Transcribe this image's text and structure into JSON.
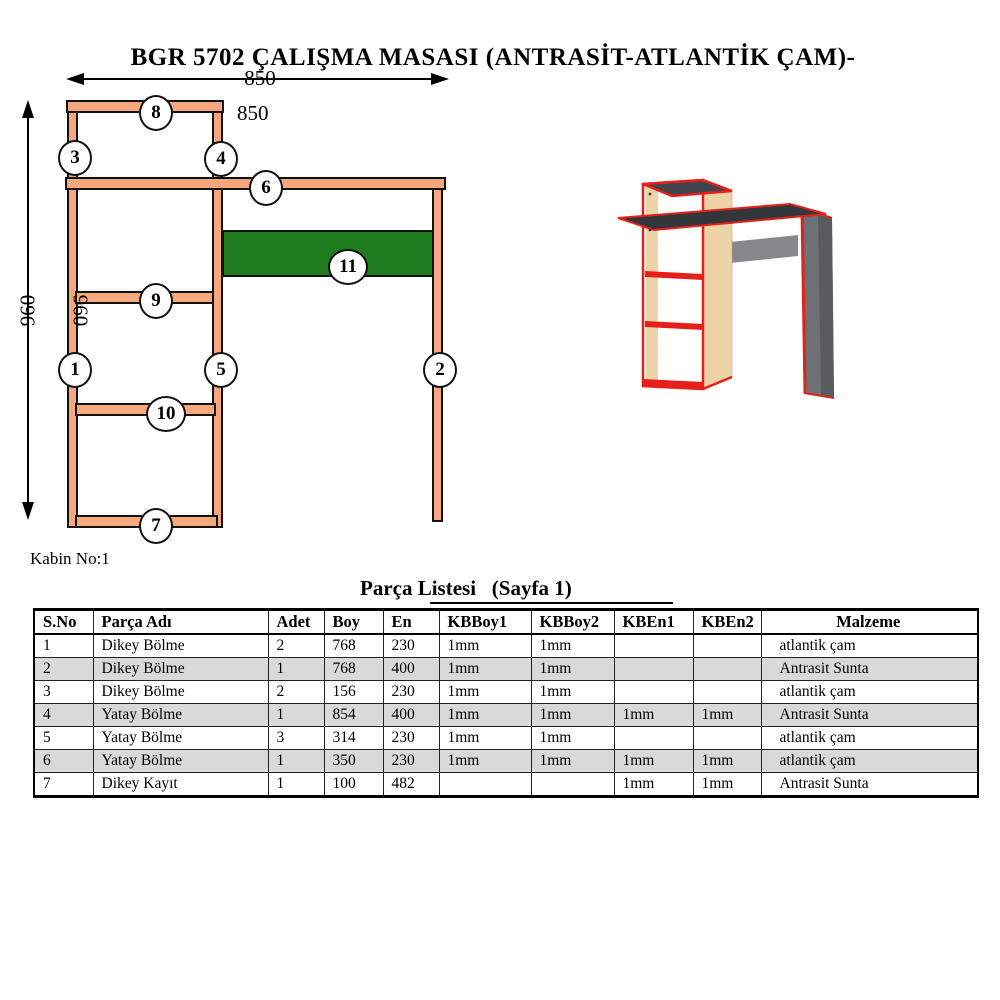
{
  "page": {
    "title": "BGR 5702 ÇALIŞMA MASASI (ANTRASİT-ATLANTİK ÇAM)-",
    "cabinet_label": "Kabin No:1"
  },
  "diagram": {
    "dim_width_label": "850",
    "dim_width_label_secondary": "850",
    "dim_height_label": "960",
    "dim_height_label_secondary": "960",
    "callouts": [
      "1",
      "2",
      "3",
      "4",
      "5",
      "6",
      "7",
      "8",
      "9",
      "10",
      "11"
    ]
  },
  "colors": {
    "part_fill": "#F5A77E",
    "part_outline": "#111111",
    "shelf_green": "#1E7B1E",
    "table_stripe": "#D9D9D9",
    "wood": "#ECD4A6",
    "anthracite": "#33373C",
    "side_panel_gray": "#6D7176",
    "back_rail_gray": "#84888D",
    "edge_red": "#E62019"
  },
  "parts_table": {
    "title": "Parça Listesi   (Sayfa 1)",
    "headers": [
      "S.No",
      "Parça Adı",
      "Adet",
      "Boy",
      "En",
      "KBBoy1",
      "KBBoy2",
      "KBEn1",
      "KBEn2",
      "Malzeme"
    ],
    "rows": [
      [
        "1",
        "Dikey Bölme",
        "2",
        "768",
        "230",
        "1mm",
        "1mm",
        "",
        "",
        "atlantik çam"
      ],
      [
        "2",
        "Dikey Bölme",
        "1",
        "768",
        "400",
        "1mm",
        "1mm",
        "",
        "",
        "Antrasit Sunta"
      ],
      [
        "3",
        "Dikey Bölme",
        "2",
        "156",
        "230",
        "1mm",
        "1mm",
        "",
        "",
        "atlantik çam"
      ],
      [
        "4",
        "Yatay Bölme",
        "1",
        "854",
        "400",
        "1mm",
        "1mm",
        "1mm",
        "1mm",
        "Antrasit Sunta"
      ],
      [
        "5",
        "Yatay Bölme",
        "3",
        "314",
        "230",
        "1mm",
        "1mm",
        "",
        "",
        "atlantik çam"
      ],
      [
        "6",
        "Yatay Bölme",
        "1",
        "350",
        "230",
        "1mm",
        "1mm",
        "1mm",
        "1mm",
        "atlantik çam"
      ],
      [
        "7",
        "Dikey Kayıt",
        "1",
        "100",
        "482",
        "",
        "",
        "1mm",
        "1mm",
        "Antrasit Sunta"
      ]
    ]
  }
}
